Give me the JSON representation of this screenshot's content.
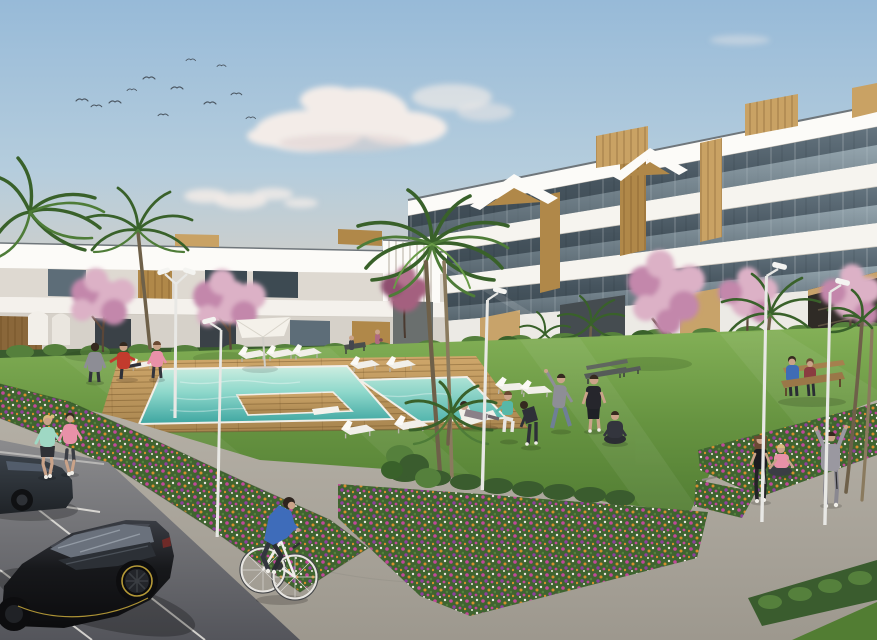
{
  "meta": {
    "type": "architectural-rendering",
    "subject": "Modern white residential apartment complex with communal pool, gardens, parking and people exercising"
  },
  "scene": {
    "sky": {
      "birds_count": 12,
      "clouds": "soft cumulus, warm haze at horizon"
    },
    "buildings": {
      "left": "two-storey white apartments with wood slat accents and dark glazing",
      "right": "three-storey white apartment block with tinted glass balconies, wood panels and rooftop boxes"
    },
    "pool": {
      "shape": "L-shaped turquoise pool with wooden deck and deck island",
      "sun_loungers": 9,
      "deck_chairs": 1,
      "umbrellas": 1,
      "diving_board": 1
    },
    "people": {
      "total": 19,
      "activities": [
        "jogging",
        "cycling",
        "stretching",
        "squatting",
        "yoga-meditation",
        "lounging",
        "sitting on bench",
        "jumping"
      ]
    },
    "vehicles": {
      "cars": 2,
      "bicycles": 1
    },
    "vegetation": {
      "palm_trees": 8,
      "pink_blossom_trees": 6,
      "flower_beds": 4,
      "hedges": 3
    },
    "street_lamps": 5,
    "benches": 4
  },
  "colors": {
    "skyTop": "#97bad8",
    "skyMid": "#b5cddd",
    "skyLow": "#d6cfc5",
    "skyHorizon": "#e9dac5",
    "cloud": "#f3ece8",
    "cloudShadow": "#dcd1cf",
    "bird": "#4a5560",
    "bldWhite": "#f6f4ef",
    "bldBright": "#fcfbf8",
    "bldShade": "#ded9d1",
    "bldShade2": "#d6d1c9",
    "roofEdge": "#6f767b",
    "glassDark": "#3d4a52",
    "glassMid": "#5d6d78",
    "glassLight": "#aebfc7",
    "wood": "#b08849",
    "woodLight": "#c9a264",
    "woodDark": "#8a673a",
    "stucco": "#c8a36a",
    "hedge": "#3a5c2e",
    "hedgeLight": "#55803c",
    "grass": "#679441",
    "grassLight": "#84b157",
    "grassDark": "#527d33",
    "poolFar": "#cdeee1",
    "poolNear": "#3da5a0",
    "deck": "#cfa76b",
    "deckDark": "#a8854f",
    "coping": "#f2efe8",
    "path": "#b7b2a8",
    "pathDark": "#a19c92",
    "stepShadow": "#8d8a82",
    "asphalt": "#8b8b8d",
    "asphaltDark": "#5c5c62",
    "lineWhite": "#e8e6e0",
    "bedGreen": "#3f6430",
    "flMagenta": "#c2489a",
    "flOrange": "#d98e2e",
    "flWhite": "#efe8e2",
    "flPurple": "#8f3f9e",
    "blossom": "#dcb1c6",
    "blossomDeep": "#c387ab",
    "blossomMauve": "#a4617f",
    "palm": "#4e7c38",
    "palmDark": "#39612a",
    "palmLight": "#699b47",
    "trunk": "#8a7a5e",
    "trunkDark": "#6e6049",
    "lamp": "#e8e8e5",
    "lampBright": "#f4f4f1",
    "carBody": "#17181b",
    "carGloss": "#4a4e56",
    "carWindow": "#565c64",
    "carAccent": "#c8a93c",
    "sedan": "#2b3138",
    "skin": "#caa389",
    "hairDark": "#35291f",
    "hairBlonde": "#d9b97e",
    "hairBrown": "#6b4a33",
    "outfitDark": "#2e3038",
    "red": "#c23b2d",
    "pink": "#e891a8",
    "teal": "#57b8a8",
    "blue": "#3e6cba",
    "gray": "#8e8e96",
    "denim": "#6f7f96",
    "mint": "#9fd8c4",
    "hoodie": "#9a98a0",
    "whiteCloth": "#f1efe9",
    "benchWood": "#9a7748"
  }
}
